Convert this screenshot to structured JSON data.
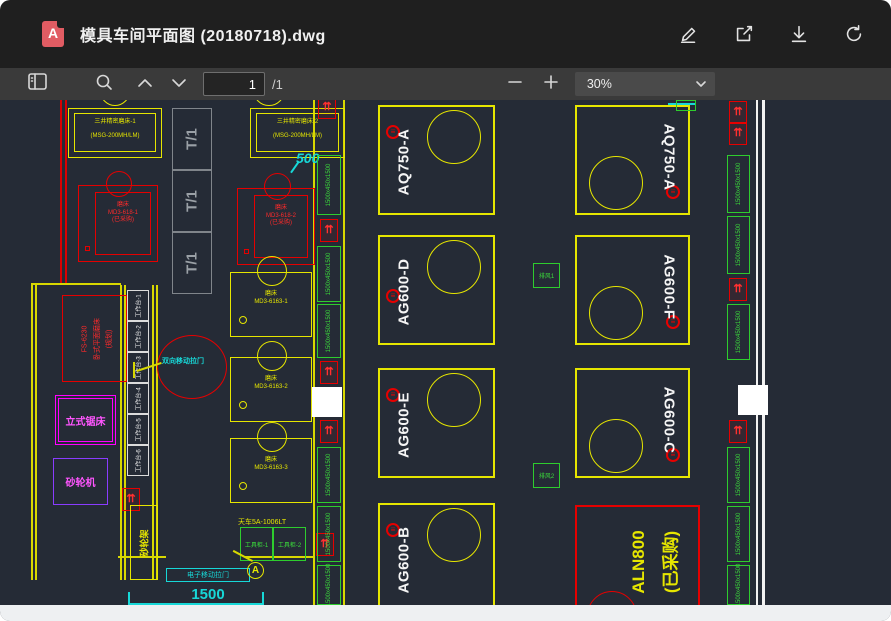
{
  "titlebar": {
    "title": "模具车间平面图 (20180718).dwg",
    "file_icon_letter": "A"
  },
  "toolbar": {
    "page_value": "1",
    "page_total": "/1",
    "zoom_value": "30%"
  },
  "icons": {
    "outlet_glyph": "⇈",
    "power_glyph": "≡"
  },
  "drawing": {
    "dim_500": "500",
    "dim_1500": "1500",
    "t1": [
      "T/1",
      "T/1",
      "T/1"
    ],
    "mitsui_grinders": [
      {
        "line1": "三井精密磨床-1",
        "line2": "(MSG-200MH/LM)"
      },
      {
        "line1": "三井精密磨床-2",
        "line2": "(MSG-200MH/LM)"
      }
    ],
    "red_grinders": [
      {
        "line1": "磨床",
        "line2": "MD3-618-1",
        "line3": "(已采购)"
      },
      {
        "line1": "磨床",
        "line2": "MD3-618-2",
        "line3": "(已采购)"
      }
    ],
    "yellow_grinders": [
      {
        "line1": "磨床",
        "line2": "MD3-6163-1"
      },
      {
        "line1": "磨床",
        "line2": "MD3-6163-2"
      },
      {
        "line1": "磨床",
        "line2": "MD3-6163-3"
      }
    ],
    "planned_grinder": {
      "line1": "FS-6230",
      "line2": "卧式平面磨床",
      "line3": "(规划)"
    },
    "vertical_saw": "立式锯床",
    "bench_grinder": "砂轮机",
    "workbenches": [
      "工作台-1",
      "工作台-2",
      "工作台-3",
      "工作台-4",
      "工作台-5",
      "工作台-6"
    ],
    "sliding_door_note": "双向移动拉门",
    "electric_door": "电子移动拉门",
    "wheel_rack": "砂轮架",
    "crane": "天车5A-1006LT",
    "tool_cabinets": [
      "工具柜-1",
      "工具柜-2"
    ],
    "marker_a": "A",
    "machines_left": [
      "AQ750-A",
      "AG600-D",
      "AG600-E",
      "AG600-B"
    ],
    "machines_right": [
      "AQ750-A",
      "AG600-F",
      "AG600-C"
    ],
    "purchased_machine": {
      "line1": "ALN800",
      "line2": "(已采购)"
    },
    "vents": [
      "排风1",
      "排风2"
    ],
    "bench_dim": "1500x450x1500"
  },
  "colors": {
    "canvas_bg": "#252b36",
    "cad_yellow": "#e6e600",
    "cad_red": "#e60000",
    "cad_green": "#2ecc2e",
    "cad_cyan": "#17d8d8",
    "cad_magenta": "#ff00ff",
    "cad_violet": "#8a3cff"
  }
}
